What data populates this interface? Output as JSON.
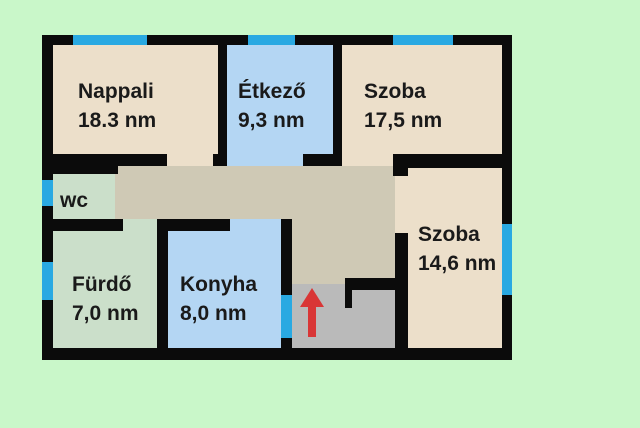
{
  "floorplan": {
    "rooms": [
      {
        "id": "nappali",
        "name": "Nappali",
        "area": "18.3 nm"
      },
      {
        "id": "etkezo",
        "name": "Étkező",
        "area": "9,3 nm"
      },
      {
        "id": "szoba-1",
        "name": "Szoba",
        "area": "17,5 nm"
      },
      {
        "id": "szoba-2",
        "name": "Szoba",
        "area": "14,6 nm"
      },
      {
        "id": "wc",
        "name": "wc",
        "area": ""
      },
      {
        "id": "furdo",
        "name": "Fürdő",
        "area": "7,0 nm"
      },
      {
        "id": "konyha",
        "name": "Konyha",
        "area": "8,0 nm"
      }
    ],
    "colors": {
      "background": "#c9f7c9",
      "wall": "#0b0b0b",
      "room_beige": "#ecdfca",
      "room_blue": "#b4d6f3",
      "room_green": "#cbdfca",
      "hallway_tan": "#cfc9b5",
      "entrance_gray": "#bababa",
      "window_marker": "#29a9e2",
      "entrance_arrow": "#d93636",
      "text": "#1a1a1a"
    },
    "entrance_arrow_direction": "up"
  }
}
